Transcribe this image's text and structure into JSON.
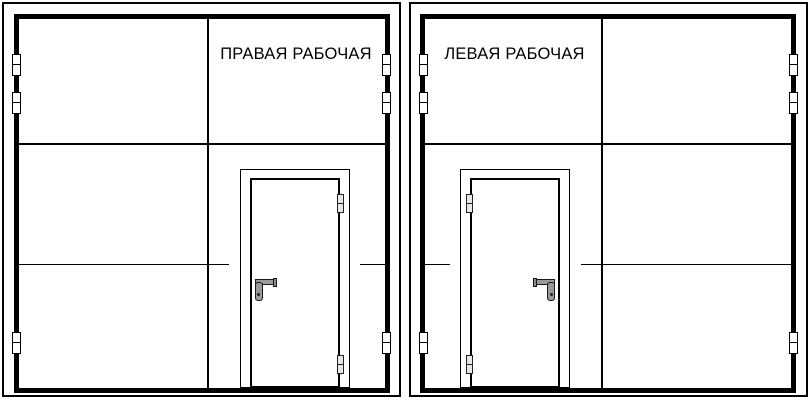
{
  "diagram": {
    "type": "technical-drawing",
    "subject": "double industrial gate leaves with built-in wicket doors, orientation options",
    "colors": {
      "background": "#ffffff",
      "line": "#000000",
      "handle": "#9a9a9a",
      "hinge_fill": "#ffffff",
      "door_hinge_fill": "#e8e8e8"
    },
    "gates": [
      {
        "id": "right-working",
        "label": "ПРАВАЯ РАБОЧАЯ",
        "wicket_door_side": "right",
        "door_handle_side": "left",
        "door_hinge_side": "right",
        "frame_hinges_per_side": 3
      },
      {
        "id": "left-working",
        "label": "ЛЕВАЯ РАБОЧАЯ",
        "wicket_door_side": "left",
        "door_handle_side": "right",
        "door_hinge_side": "left",
        "frame_hinges_per_side": 3
      }
    ],
    "icons": [
      "gate-hinge-icon",
      "door-hinge-icon",
      "door-handle-icon"
    ]
  }
}
